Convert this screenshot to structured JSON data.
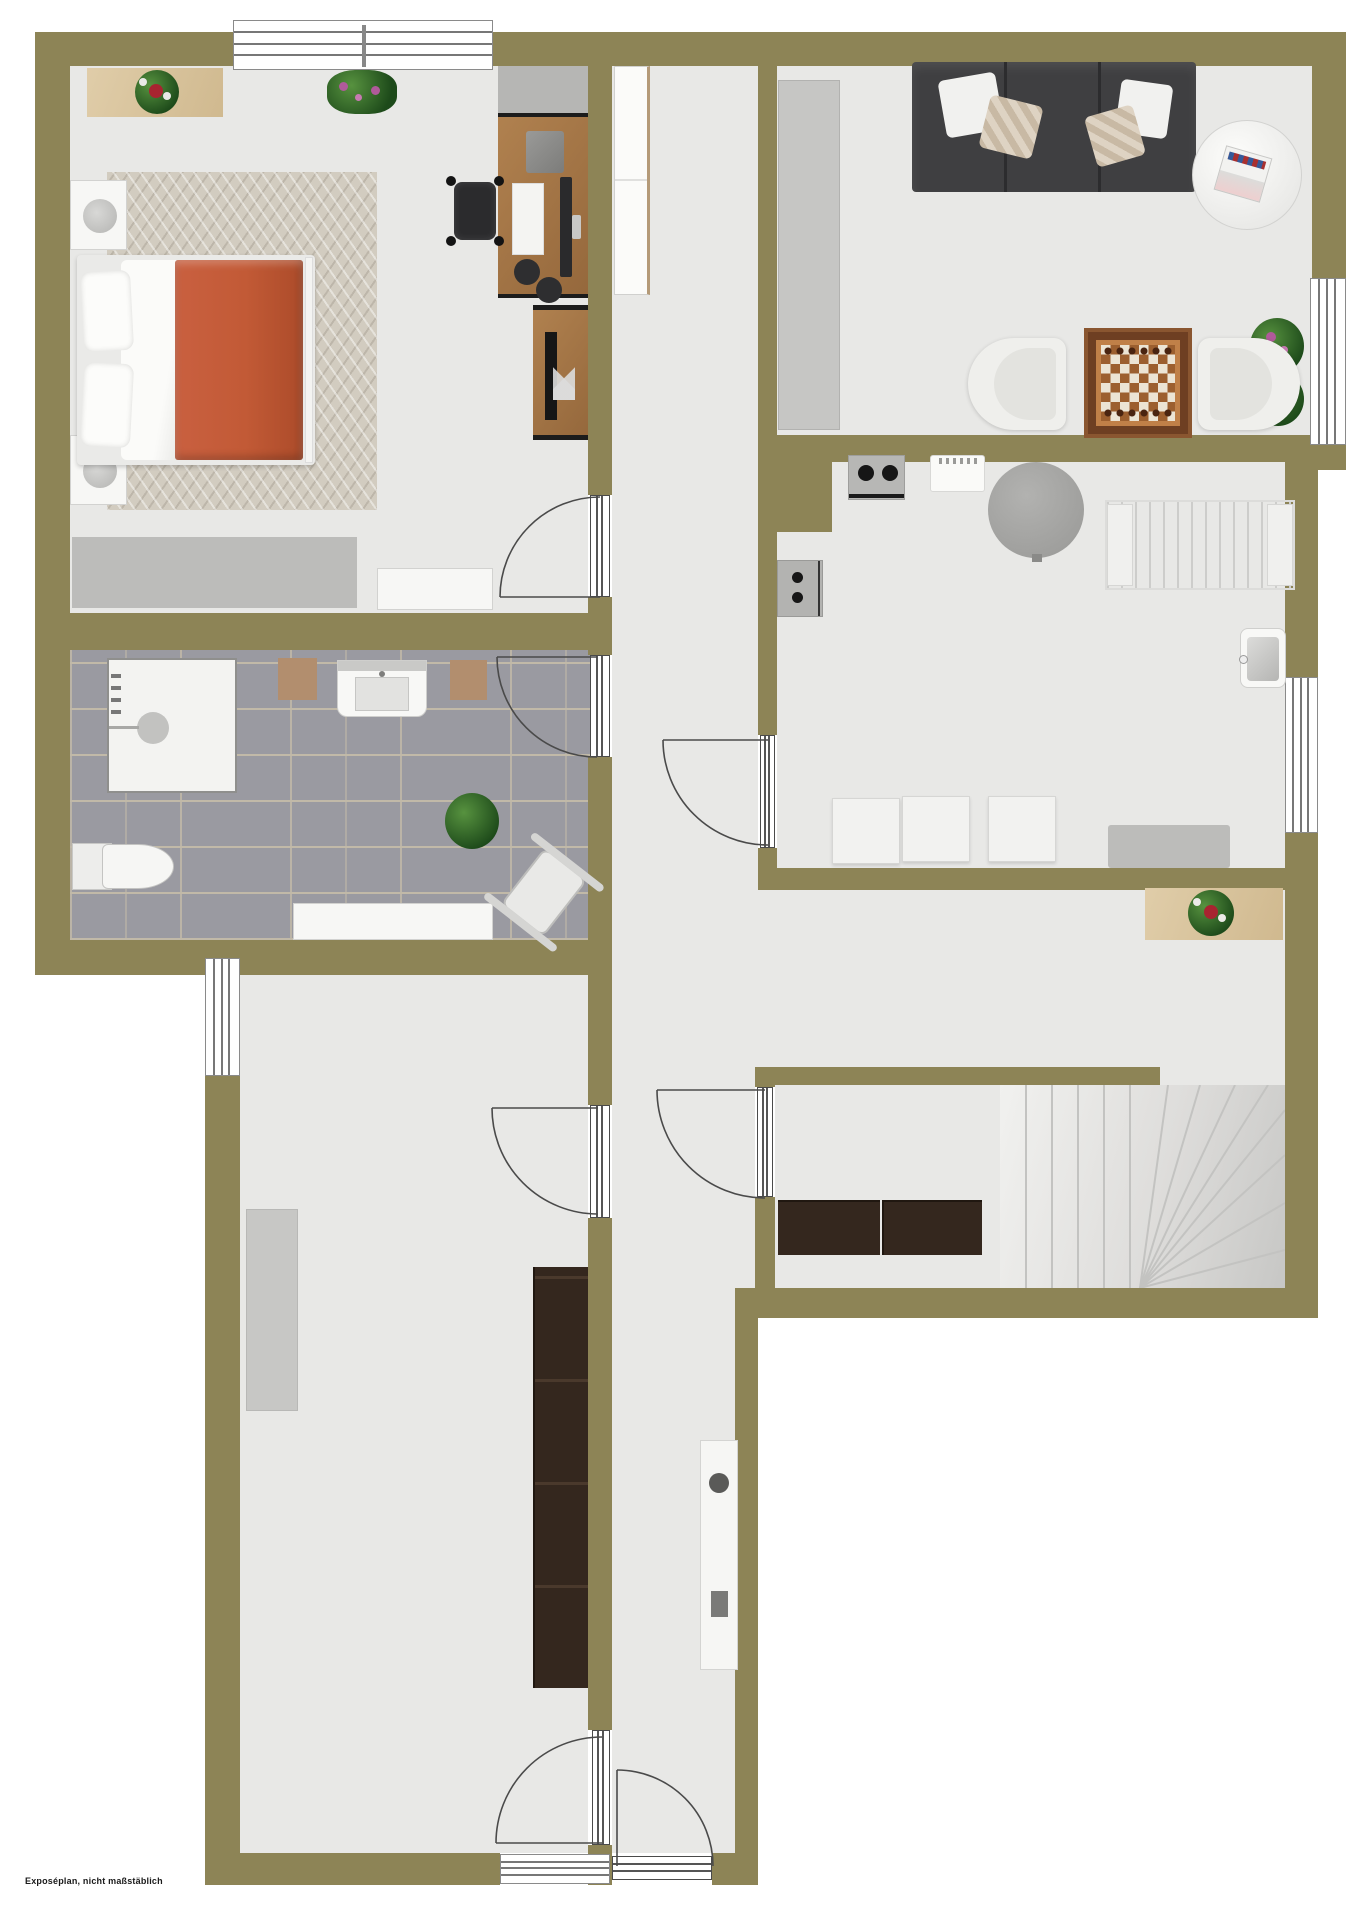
{
  "meta": {
    "type": "floor-plan",
    "style": "rendered top-down exposé plan"
  },
  "footer": {
    "note": "Exposéplan, nicht maßstäblich"
  },
  "palette": {
    "wall": "#8d8456",
    "floor": "#e8e8e6",
    "bath_tile": "#9a9aa1",
    "grout": "#c1b9a8",
    "outside": "#ffffff",
    "carpet": "#d2ccc0",
    "wood": "#a97c50",
    "light_wood": "#dcc9a3",
    "dark_wood": "#34271e",
    "sofa": "#3f3f41",
    "bed_blanket_orange": "#c25a36",
    "armchair_cream": "#efefec",
    "plant_green": "#2f6b2c",
    "bloom_purple": "#b05a9a",
    "bloom_red": "#a82430",
    "stairs_light": "#ececea"
  },
  "rooms": [
    {
      "id": "bedroom",
      "furniture": [
        "sideboard-with-bouquet",
        "potted-plant",
        "double-bed",
        "nightstand-top",
        "nightstand-bottom",
        "bedside-lamp",
        "area-rug",
        "low-dresser",
        "bench",
        "desk",
        "desk-cabinet",
        "office-chair",
        "monitor",
        "keyboard",
        "headphones",
        "tv-sideboard",
        "tv"
      ]
    },
    {
      "id": "bathroom",
      "furniture": [
        "shower",
        "washbasin",
        "bath-mat-left",
        "bath-mat-right",
        "toilet",
        "shelf-bench",
        "potted-plant",
        "exercise-bench"
      ]
    },
    {
      "id": "hallway",
      "furniture": [
        "tall-cabinet",
        "console-table"
      ]
    },
    {
      "id": "living-room",
      "furniture": [
        "wardrobe",
        "sofa",
        "throw-pillows",
        "round-coffee-table",
        "magazine",
        "potted-plant",
        "armchair-left",
        "chess-table",
        "armchair-right"
      ]
    },
    {
      "id": "kitchen",
      "furniture": [
        "stove",
        "sink-unit",
        "washing-machine",
        "round-table",
        "drying-rack",
        "chair-1",
        "chair-2",
        "chair-3",
        "bench",
        "corner-sink"
      ]
    },
    {
      "id": "landing",
      "furniture": [
        "flower-shelf"
      ]
    },
    {
      "id": "stair-room",
      "furniture": [
        "winder-staircase",
        "cabinet-left",
        "cabinet-right"
      ]
    },
    {
      "id": "large-room",
      "furniture": [
        "gray-sideboard",
        "dark-shelf-unit"
      ]
    }
  ],
  "openings": {
    "windows": 5,
    "doors": 7,
    "door_style": "white frame, quarter-circle swing arc"
  }
}
